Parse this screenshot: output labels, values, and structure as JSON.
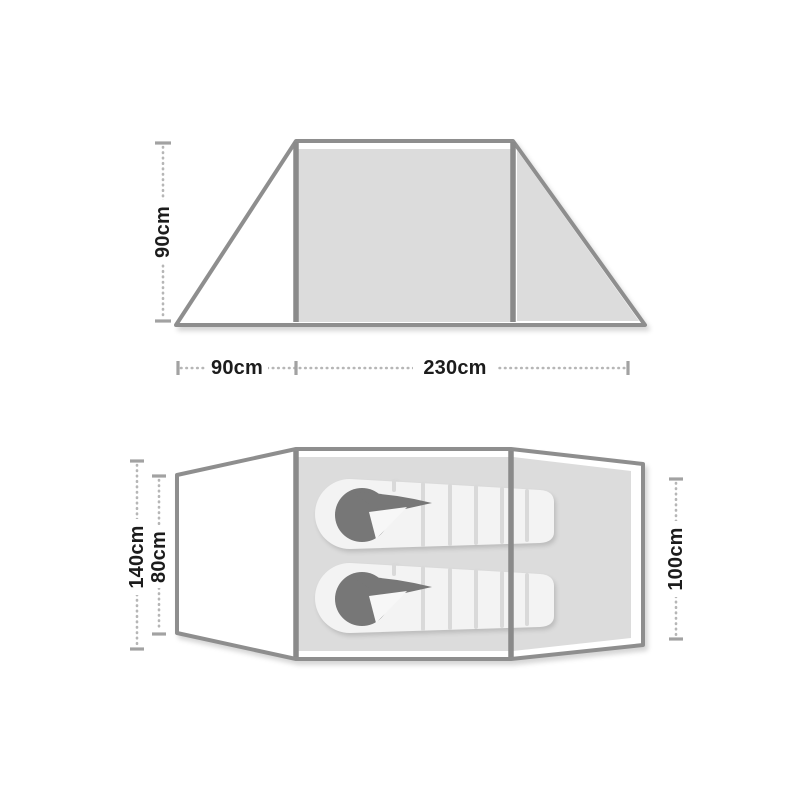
{
  "side_view": {
    "height_label": "90cm",
    "porch_width_label": "90cm",
    "main_width_label": "230cm"
  },
  "top_view": {
    "total_width_label": "140cm",
    "inner_width_label": "80cm",
    "foot_end_width_label": "100cm"
  },
  "colors": {
    "background": "#ffffff",
    "outline": "#8e8e8e",
    "pole": "#8a8a8a",
    "fabric": "#dcdcdc",
    "porch": "#ffffff",
    "bag": "#f3f3f3",
    "baffle": "#d9d9d9",
    "hood": "#777777",
    "hood_fold": "#f7f7f7",
    "dots": "#b6b6b6",
    "caps": "#a2a2a2",
    "text": "#1c1c1c"
  }
}
